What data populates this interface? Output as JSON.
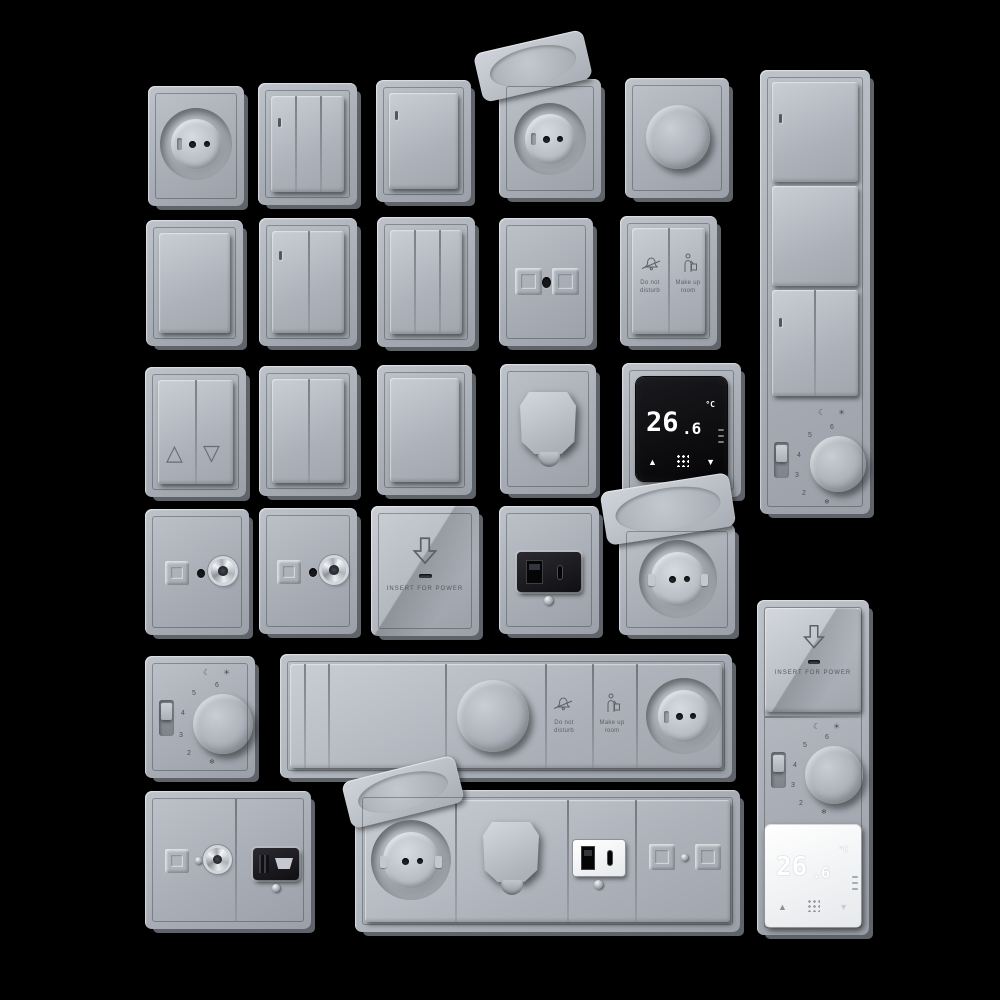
{
  "scene": {
    "background_color": "#000000",
    "plate_color": "#aab0b8",
    "plate_edge_color": "#5f646b",
    "black_module_color": "#141417",
    "display_digit_color": "#ffffff"
  },
  "labels": {
    "do_not_disturb": "Do not disturb",
    "make_up_room": "Make up room",
    "insert_for_power": "INSERT FOR POWER"
  },
  "thermostat_display": {
    "temp_main": "26",
    "temp_frac": ".6",
    "unit": "°C",
    "up_icon": "▲",
    "down_icon": "▼"
  },
  "rotary_dial": {
    "numbers": [
      "6",
      "5",
      "4",
      "3",
      "2"
    ],
    "frost_icon": "❄",
    "night_icon": "☾",
    "day_icon": "☀"
  },
  "blinds_switch": {
    "up_icon": "△",
    "down_icon": "▽"
  },
  "items": [
    "round socket",
    "3-gang switch",
    "1-gang switch",
    "socket with flip cover",
    "rotary dimmer",
    "vertical switch panel with rotary thermostat",
    "blank 1-gang switch",
    "2-gang switch",
    "3-gang switch",
    "twin module outlet",
    "hotel service switch",
    "shutter switch",
    "2-gang switch",
    "1-gang switch",
    "cable outlet",
    "digital thermostat black",
    "tv sat socket",
    "tv sat socket",
    "key card power switch",
    "usb charger black",
    "socket with open cover",
    "rotary thermostat",
    "horizontal combination strip with dimmer, hotel switch and socket",
    "tv hdmi combination plate",
    "horizontal combination strip with socket, cable outlet and usb",
    "vertical strip with key card, rotary thermostat and white digital thermostat"
  ]
}
